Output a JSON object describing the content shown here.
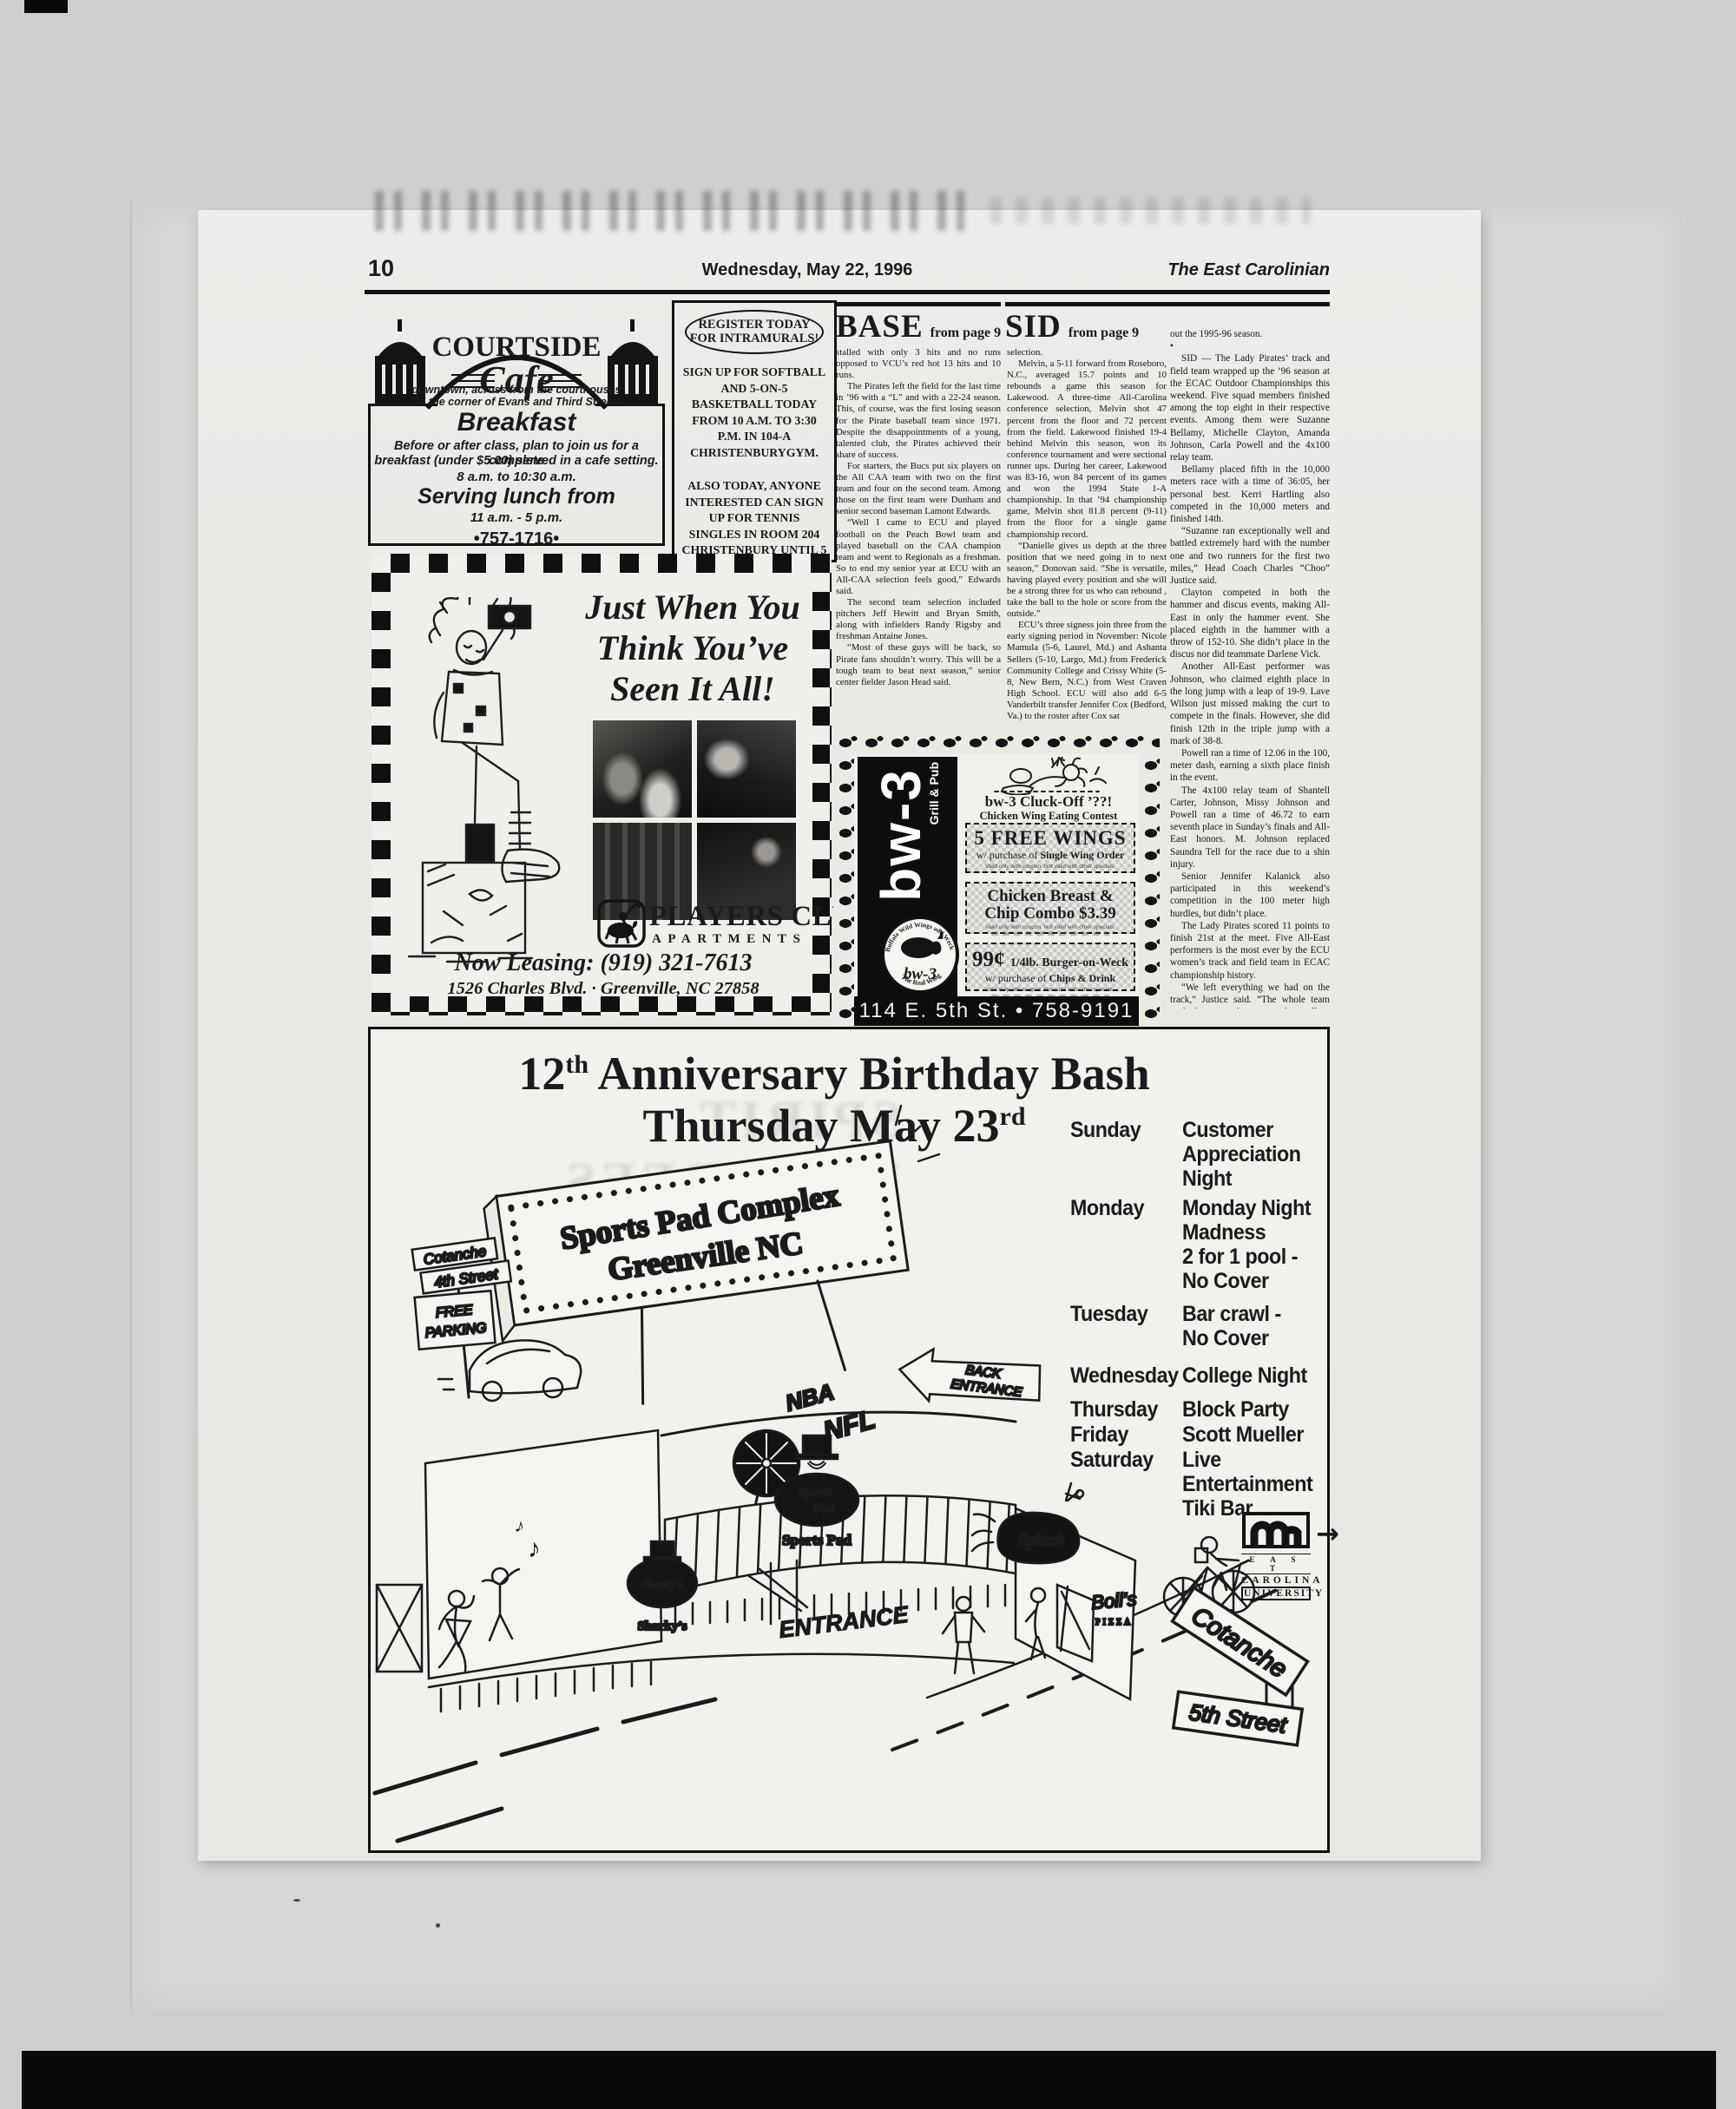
{
  "page": {
    "number": "10",
    "date": "Wednesday, May 22, 1996",
    "publication": "The East Carolinian",
    "ghost_headline": "SPIRIT HONOREES"
  },
  "courtside_ad": {
    "brand": "COURTSIDE",
    "brand_script": "Cafe",
    "tagline1": "downtown, across from the courthouses",
    "tagline2": "On the corner of Evans and Third Streets",
    "heading": "Breakfast",
    "body1": "Before or after class, plan to join us for a complete",
    "body2": "breakfast (under $5.00) served in a cafe setting.",
    "hours_breakfast": "8 a.m. to 10:30 a.m.",
    "lunch_heading": "Serving lunch from",
    "hours_lunch": "11 a.m. - 5 p.m.",
    "phone": "•757-1716•"
  },
  "intramurals_ad": {
    "title1": "REGISTER TODAY",
    "title2": "FOR INTRAMURALS!",
    "body1": "SIGN UP FOR SOFTBALL AND 5-ON-5 BASKETBALL TODAY FROM 10 A.M. TO 3:30 P.M. IN 104-A CHRISTENBURYGYM.",
    "body2": "ALSO TODAY, ANYONE INTERESTED CAN SIGN UP FOR TENNIS SINGLES IN ROOM 204 CHRISTENBURY UNTIL 5 P.M."
  },
  "base_article": {
    "slug": "BASE",
    "from_label": "from page 9",
    "paragraphs": [
      "stalled with only 3 hits and no runs opposed to VCU’s red hot 13 hits and 10 runs.",
      "The Pirates left the field for the last time in ’96 with a “L” and with a 22-24 season. This, of course, was the first losing season for the Pirate baseball team since 1971. Despite the disappointments of a young, talented club, the Pirates achieved their share of success.",
      "For starters, the Bucs put six players on the All CAA team with two on the first team and four on the second team. Among those on the first team were Dunham and senior second baseman Lamont Edwards.",
      "“Well I came to ECU and played football on the Peach Bowl team and played baseball on the CAA champion team and went to Regionals as a freshman. So to end my senior year at ECU with an All-CAA selection feels good,” Edwards said.",
      "The second team selection included pitchers Jeff Hewitt and Bryan Smith, along with infielders Randy Rigsby and freshman Antaine Jones.",
      "“Most of these guys will be back, so Pirate fans shouldn’t worry. This will be a tough team to beat next season,” senior center fielder Jason Head said."
    ]
  },
  "sid_article": {
    "slug": "SID",
    "from_label": "from page 9",
    "bullet": "•",
    "col1_paragraphs": [
      "selection.",
      "Melvin, a 5-11 forward from Roseboro, N.C., averaged 15.7 points and 10 rebounds a game this season for Lakewood. A three-time All-Carolina conference selection, Melvin shot 47 percent from the floor and 72 percent from the field. Lakewood finished 19-4 behind Melvin this season, won its conference tournament and were sectional runner ups. During her career, Lakewood was 83-16, won 84 percent of its games and won the 1994 State 1-A championship. In that ’94 championship game, Melvin shot 81.8 percent (9-11) from the floor for a single game championship record.",
      "“Danielle gives us depth at the three position that we need going in to next season,” Donovan said. “She is versatile, having played every position and she will be a strong three for us who can rebound , take the ball to the hole or score from the outside.”",
      "ECU’s three signess join three from the early signing period in November: Nicole Mamula (5-6, Laurel, Md.) and Ashanta Sellers (5-10, Largo, Md.) from Frederick Community College and Crissy White (5-8, New Bern, N.C.) from West Craven High School. ECU will also add 6-5 Vanderbilt transfer Jennifer Cox (Bedford, Va.) to the roster after Cox sat"
    ],
    "col2_paragraphs": [
      "out the 1995-96 season.",
      "SID — The Lady Pirates’ track and field team wrapped up the ’96 season at the ECAC Outdoor Championships this weekend. Five squad members finished among the top eight in their respective events. Among them were Suzanne Bellamy, Michelle Clayton, Amanda Johnson, Carla Powell and the 4x100 relay team.",
      "Bellamy placed fifth in the 10,000 meters race with a time of 36:05, her personal best. Kerri Hartling also competed in the  10,000 meters and finished 14th.",
      "“Suzanne ran exceptionally well and battled extremely hard with the number one and  two runners for the first two miles,” Head Coach Charles “Choo” Justice said.",
      "Clayton competed in both the hammer and discus events, making All-East in only the hammer event. She placed eighth in the hammer with a throw of 152-10. She didn’t place in the discus nor did teammate Darlene Vick.",
      "Another All-East performer was Johnson, who claimed eighth place in the long jump with a leap of 19-9. Lave Wilson just missed making the curt to compete in the finals. However, she did finish 12th in the triple jump with a mark of 38-8.",
      "Powell ran a time of 12.06 in the 100, meter dash, earning a sixth place finish in the event.",
      "The 4x100 relay team of Shantell Carter, Johnson, Missy Johnson and Powell ran a time of 46.72 to earn seventh place in Sunday’s finals and All-East honors. M. Johnson replaced Saundra Tell for the race due to a shin injury.",
      "Senior Jennifer Kalanick also participated in this weekend’s competition in the 100 meter high hurdles, but didn’t place.",
      "The Lady Pirates scored 11 points to finish 21st at the meet. Five All-East performers is the most ever by the ECU women’s track and field team in ECAC championship history.",
      "“We left everything we had on the track,” Justice said. “The whole team sucked it up and gave a valiant effort. Everybody did well.”"
    ]
  },
  "players_ad": {
    "headline1": "Just When You",
    "headline2": "Think You’ve",
    "headline3": "Seen It All!",
    "brand": "PLAYERS CLUB",
    "brand_sub": "APARTMENTS",
    "leasing": "Now Leasing: (919) 321-7613",
    "address": "1526 Charles Blvd. · Greenville, NC 27858"
  },
  "bw3_ad": {
    "vertical_brand": "bw-3",
    "vertical_sub": "Grill & Pub",
    "contest_title": "bw-3 Cluck-Off ’??!",
    "contest_sub": "Chicken Wing Eating Contest",
    "coupon1_big": "5 FREE WINGS",
    "coupon1_sub_prefix": "w/ purchase of ",
    "coupon1_sub_bold": "Single Wing Order",
    "coupon2_line1": "Chicken Breast &",
    "coupon2_line2": "Chip Combo  $3.39",
    "coupon3_price": "99¢ ",
    "coupon3_item": "1/4lb. Burger-on-Weck",
    "coupon3_sub_prefix": "w/ purchase of ",
    "coupon3_sub_bold": "Chips & Drink",
    "fine_print": "Valid only with coupon. Not valid with other specials.",
    "logo_ring_top": "Buffalo Wild Wings and Weck",
    "logo_center": "bw-3",
    "logo_ring_bottom": "The Real Wing",
    "address": "114 E. 5th St.  •  758-9191"
  },
  "sportspad_ad": {
    "title_num": "12",
    "title_sup": "th",
    "title_rest": " Anniversary Birthday Bash",
    "subtitle_text": "Thursday May 23",
    "subtitle_sup": "rd",
    "schedule": [
      {
        "day": "Sunday",
        "lines": [
          "Customer",
          "Appreciation",
          "Night"
        ]
      },
      {
        "day": "Monday",
        "lines": [
          "Monday Night",
          "Madness",
          "2 for 1 pool -",
          "No Cover"
        ]
      },
      {
        "day": "Tuesday",
        "lines": [
          "Bar crawl -",
          "No Cover"
        ]
      },
      {
        "day": "Wednesday",
        "lines": [
          "College Night"
        ]
      },
      {
        "day": "Thursday",
        "lines": [
          "Block Party"
        ]
      },
      {
        "day": "Friday",
        "lines": [
          "Scott Mueller"
        ]
      },
      {
        "day": "Saturday",
        "lines": [
          "Live Entertainment",
          "Tiki Bar"
        ]
      }
    ],
    "billboard1": "Sports Pad Complex",
    "billboard2": "Greenville NC",
    "labels": {
      "cotanche_4th": "Cotanche",
      "fourth_street": "4th Street",
      "free1": "FREE",
      "free2": "PARKING",
      "back1": "BACK",
      "back2": "ENTRANCE",
      "nba": "NBA",
      "nfl": "NFL",
      "entrance": "ENTRANCE",
      "sharkys_script": "Sharky’s",
      "sharkys_caption": "Sharky’s",
      "sportspad_script1": "Sports",
      "sportspad_script2": "Pad",
      "sportspad_caption": "Sports Pad",
      "splash": "Splash",
      "bolis": "Boli’s",
      "bolis_sub": "PIZZA",
      "cotanche_5th": "Cotanche",
      "fifth_street": "5th Street",
      "note1": "♪",
      "note2": "♪"
    },
    "ecu": {
      "line1": "E A S T",
      "line2": "CAROLINA",
      "line3": "UNIVERSITY"
    },
    "ecu_arrow": "→"
  }
}
